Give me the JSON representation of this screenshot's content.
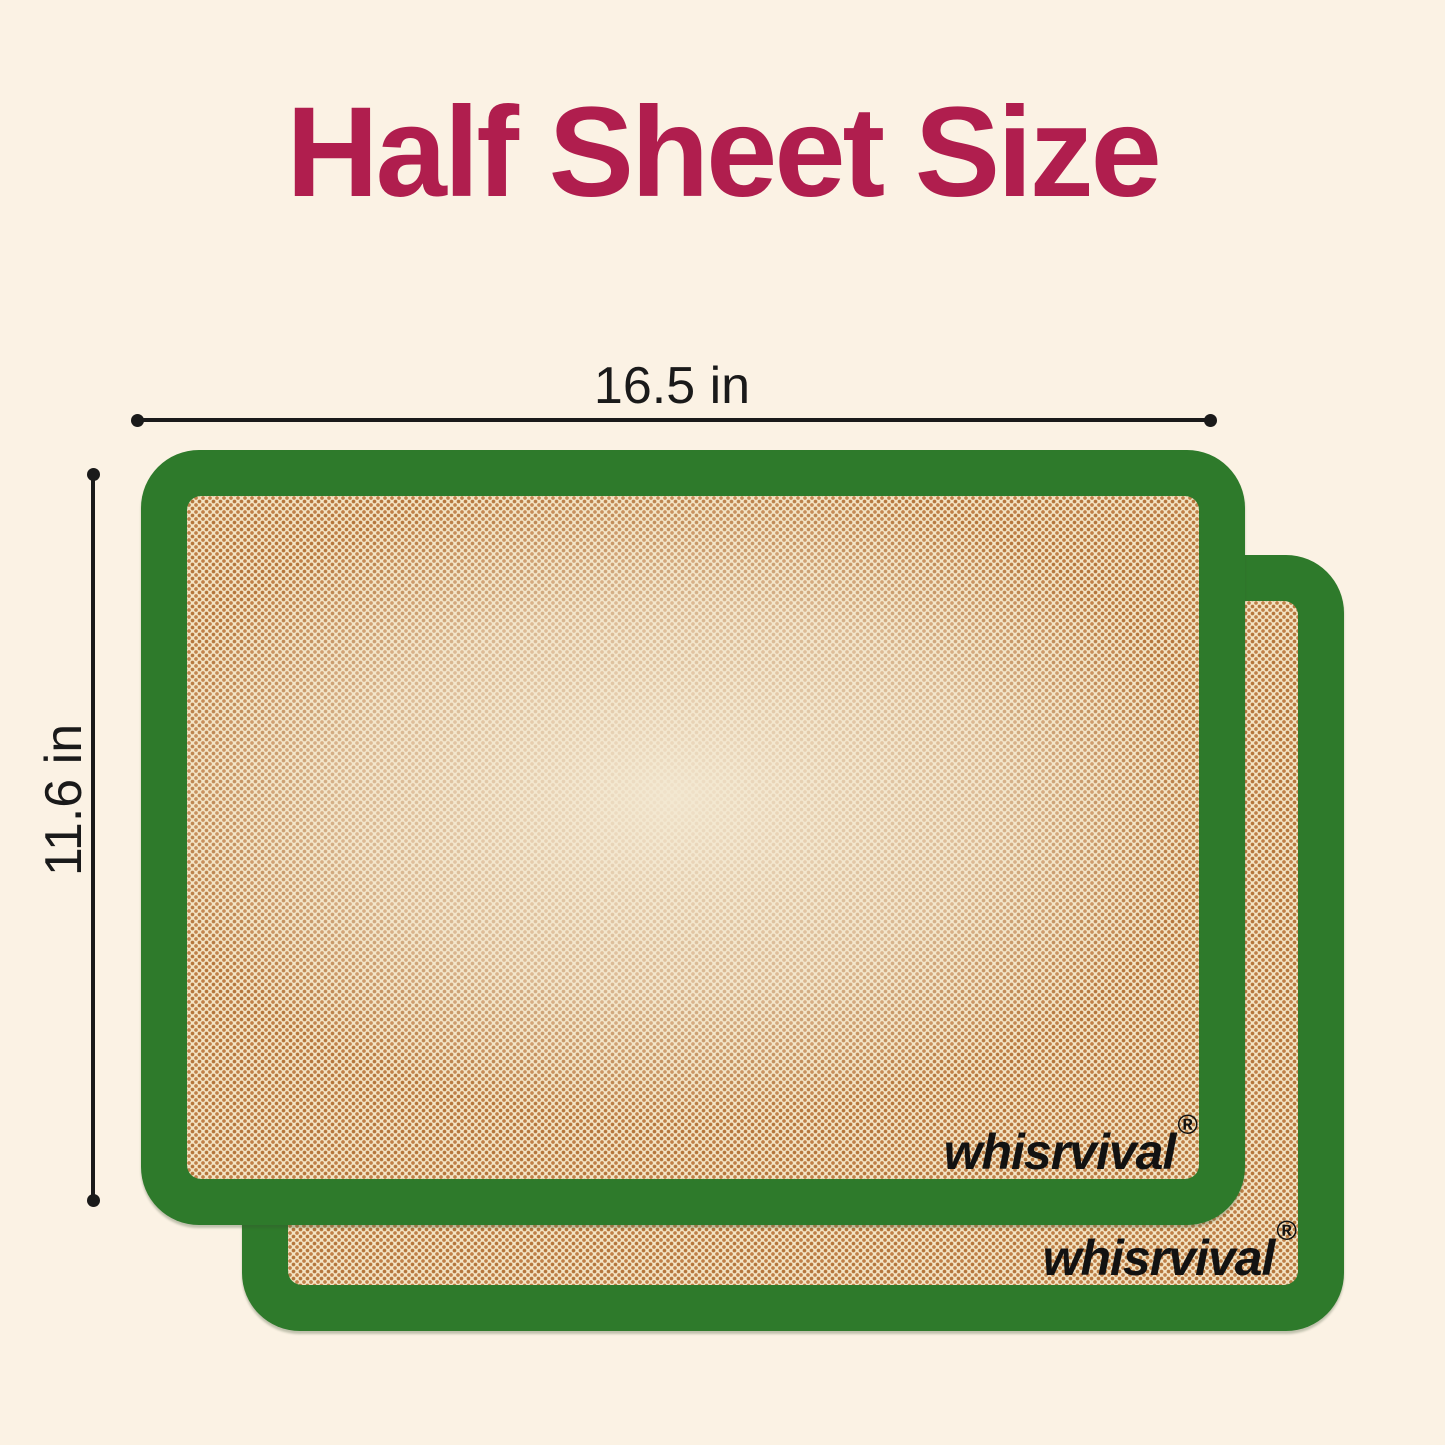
{
  "background_color": "#FBF2E4",
  "title": {
    "text": "Half Sheet Size",
    "color": "#B01E4E"
  },
  "dimension_annotations": {
    "line_color": "#1A1A1A",
    "width": {
      "label": "16.5 in"
    },
    "height": {
      "label": "11.6 in"
    }
  },
  "product": {
    "mat_count": 2,
    "brand_logo": {
      "text": "whisrvival",
      "registered_mark": "®",
      "color": "#121212"
    },
    "mat_colors": {
      "border_green": "#2E7A2B",
      "mesh_base": "#F3E4C4",
      "mesh_dot_dark": "#C08048",
      "mesh_dot_darker": "#B5763C",
      "center_highlight": "#F3E8D2"
    }
  }
}
